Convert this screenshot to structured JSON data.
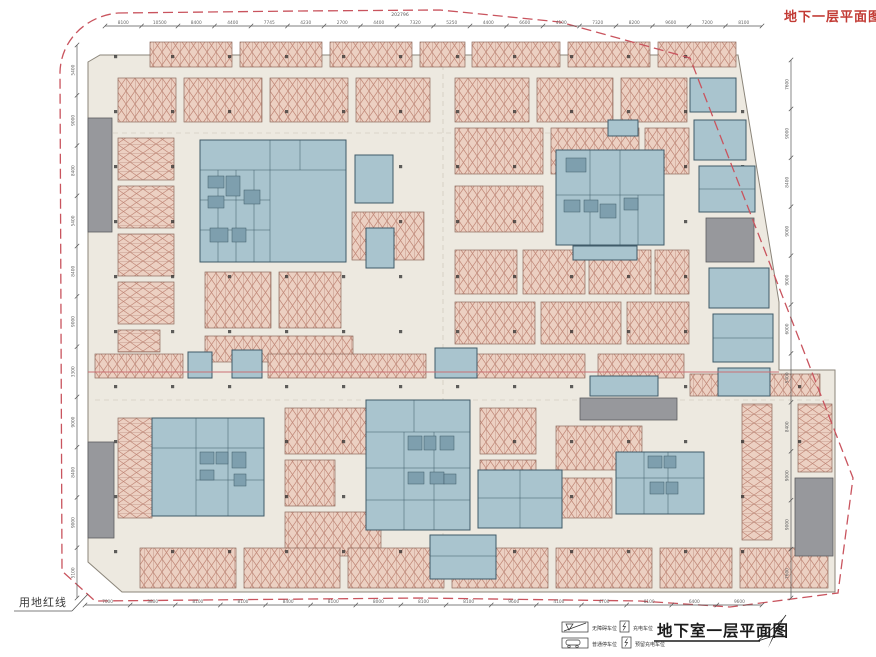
{
  "titles": {
    "plan_label_top_right": "地下一层平面图",
    "plan_title_bottom": "地下室一层平面图",
    "site_boundary_label": "用地红线"
  },
  "legend": {
    "items": [
      {
        "symbol": "accessible-parking-stall",
        "label": "无障碍车位"
      },
      {
        "symbol": "ev-charging-spot",
        "label": "充电车位"
      },
      {
        "symbol": "standard-parking-stall",
        "label": "普通停车位"
      },
      {
        "symbol": "reserved-ev-charging-spot",
        "label": "预留充电车位"
      }
    ]
  },
  "dimensions": {
    "top": {
      "total": "202796",
      "segments": [
        "8100",
        "10500",
        "8400",
        "4400",
        "7745",
        "4230",
        "2700",
        "4400",
        "7320",
        "5250",
        "4400",
        "6600",
        "4100",
        "7320",
        "8200",
        "9600",
        "7200",
        "8100"
      ]
    },
    "bottom": {
      "segments": [
        "7000",
        "3800",
        "8100",
        "8100",
        "8400",
        "8100",
        "8000",
        "8100",
        "8100",
        "9600",
        "4100",
        "4700",
        "8100",
        "6400",
        "9600"
      ]
    },
    "left": {
      "segments": [
        "5400",
        "9000",
        "8400",
        "5400",
        "8400",
        "9000",
        "3300",
        "9000",
        "8400",
        "9000",
        "5100"
      ]
    },
    "right": {
      "segments": [
        "7600",
        "9000",
        "8400",
        "9000",
        "9000",
        "6000",
        "5400",
        "8400",
        "9000",
        "9000",
        "7600"
      ]
    }
  },
  "colors": {
    "boundary_red": "#c9545e",
    "title_red": "#c23a34",
    "parking_fill": "#ecd0c2",
    "parking_hatch": "#c08777",
    "core_fill": "#a9c4ce",
    "core_stroke": "#3f5a68",
    "ramp_gray": "#97989c",
    "plate_fill": "#ede9e0"
  }
}
